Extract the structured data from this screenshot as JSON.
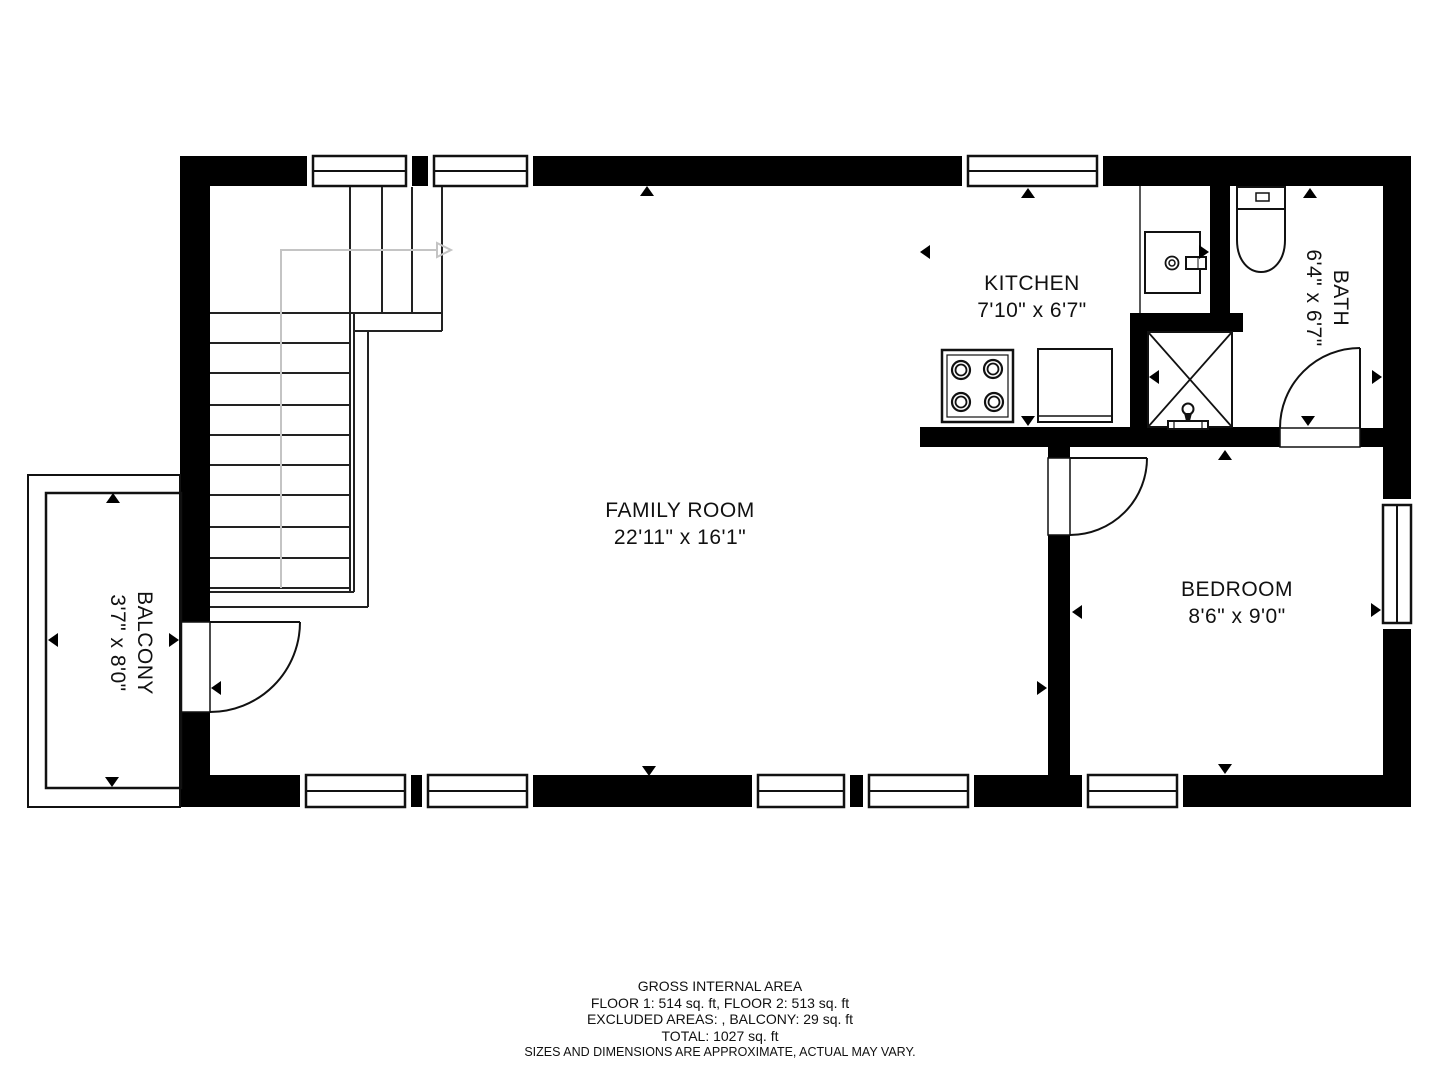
{
  "palette": {
    "background": "#ffffff",
    "wall": "#000000",
    "stair_guide": "#c4c4c4",
    "text": "#111111"
  },
  "rooms": {
    "family_room": {
      "name": "FAMILY ROOM",
      "dims": "22'11\" x 16'1\""
    },
    "kitchen": {
      "name": "KITCHEN",
      "dims": "7'10\" x 6'7\""
    },
    "bath": {
      "name": "BATH",
      "dims": "6'4\" x 6'7\""
    },
    "bedroom": {
      "name": "BEDROOM",
      "dims": "8'6\" x 9'0\""
    },
    "balcony": {
      "name": "BALCONY",
      "dims": "3'7\" x 8'0\""
    }
  },
  "footer": {
    "line1": "GROSS INTERNAL AREA",
    "line2": "FLOOR 1: 514 sq. ft, FLOOR 2: 513 sq. ft",
    "line3": "EXCLUDED AREAS: , BALCONY: 29 sq. ft",
    "line4": "TOTAL: 1027 sq. ft",
    "line5": "SIZES AND DIMENSIONS ARE APPROXIMATE, ACTUAL MAY VARY."
  }
}
